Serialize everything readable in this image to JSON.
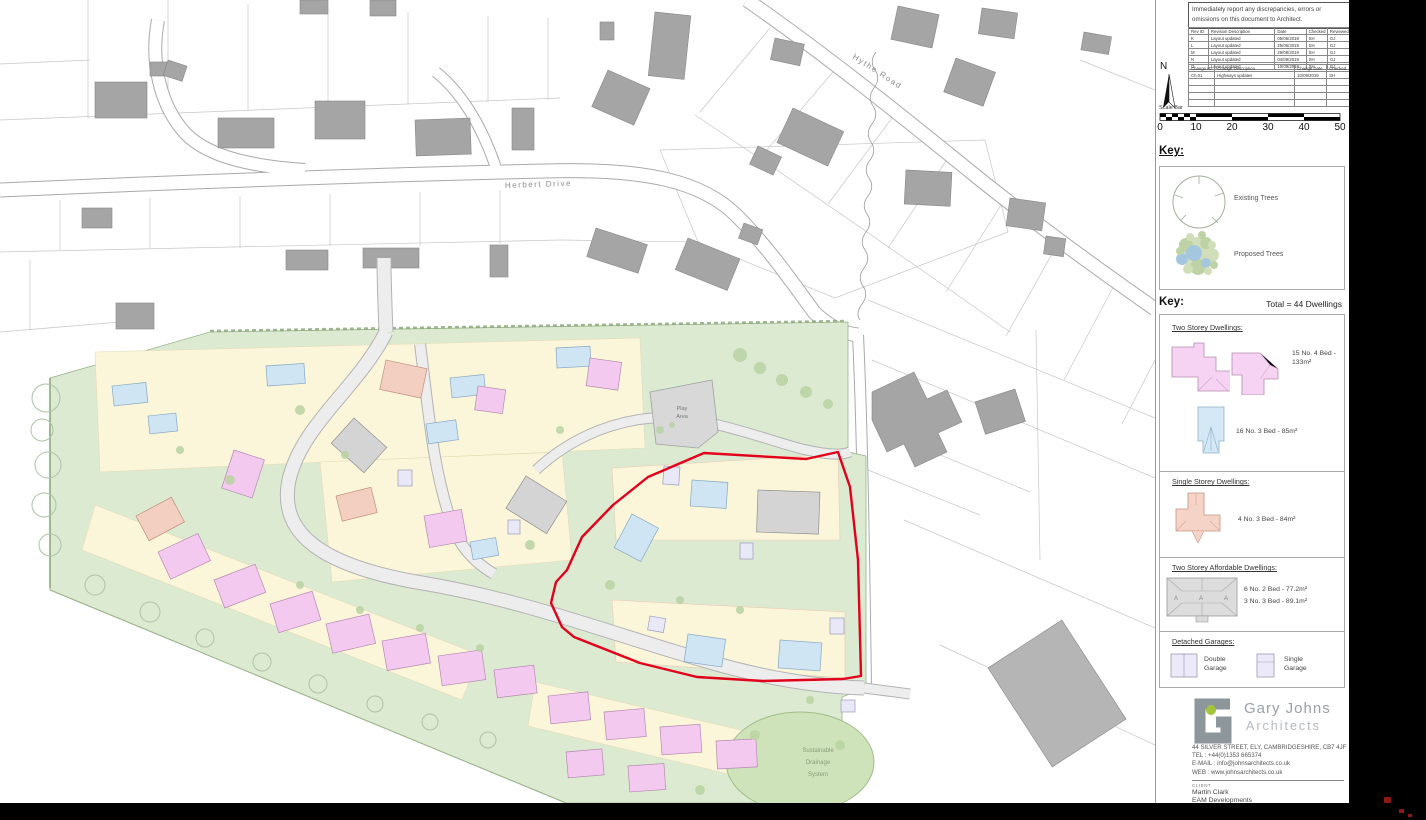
{
  "titleblock": {
    "warning": "Immediately report any discrepancies, errors or omissions on this document to Architect.",
    "revision_table": {
      "headers": [
        "Rev ID",
        "Revision Description",
        "Date",
        "Checked",
        "Reviewed"
      ],
      "rows": [
        [
          "K",
          "Layout updated",
          "05/06/2019",
          "SH",
          "GJ"
        ],
        [
          "L",
          "Layout updated",
          "25/06/2019",
          "SH",
          "GJ"
        ],
        [
          "M",
          "Layout updated",
          "29/08/2019",
          "SH",
          "GJ"
        ],
        [
          "N",
          "Layout updated",
          "04/09/2019",
          "SH",
          "GJ"
        ],
        [
          "O",
          "Layout updated",
          "10/09/2019",
          "SH",
          "GJ"
        ]
      ],
      "empty_rows": 0
    },
    "change_table": {
      "headers": [
        "Change ID",
        "Change Description",
        "Change Date",
        "Checked"
      ],
      "rows": [
        [
          "Ch.01",
          "Highways updates",
          "10/09/2019",
          "SH"
        ]
      ],
      "empty_rows": 4
    },
    "north_label": "N",
    "scale_bar": {
      "label": "Scale Bar",
      "ticks": [
        "0",
        "10",
        "20",
        "30",
        "40",
        "50"
      ]
    },
    "key_trees": {
      "title": "Key:",
      "existing_label": "Existing Trees",
      "proposed_label": "Proposed Trees"
    },
    "key_dwellings": {
      "title": "Key:",
      "total": "Total = 44 Dwellings",
      "sections": [
        {
          "heading": "Two Storey Dwellings:",
          "items": [
            "15 No. 4 Bed - 133m²",
            "16 No. 3 Bed - 85m²"
          ]
        },
        {
          "heading": "Single Storey Dwellings:",
          "items": [
            "4 No. 3 Bed - 84m²"
          ]
        },
        {
          "heading": "Two Storey Affordable Dwellings:",
          "items": [
            "6 No. 2 Bed - 77.2m²",
            "3 No. 3 Bed - 89.1m²"
          ]
        },
        {
          "heading": "Detached Garages:",
          "items": [
            "Double Garage",
            "Single Garage"
          ]
        }
      ]
    },
    "architect": {
      "name_line1": "Gary Johns",
      "name_line2": "Architects",
      "address": "44 SILVER STREET, ELY, CAMBRIDGESHIRE, CB7 4JF",
      "tel": "TEL : +44(0)1353 665374",
      "email": "E-MAIL : info@johnsarchitects.co.uk",
      "web": "WEB : www.johnsarchitects.co.uk"
    },
    "client": {
      "label": "CLIENT",
      "name": "Martin Clark",
      "company": "EAM Developments"
    }
  },
  "map": {
    "labels": {
      "herbert_drive": "Herbert Drive",
      "hythe_road": "Hythe Road",
      "play_1": "Play",
      "play_2": "Area",
      "suds_1": "Sustainable",
      "suds_2": "Drainage",
      "suds_3": "System"
    },
    "colors": {
      "site_green": "#dcead2",
      "plot_cream": "#fbf6da",
      "two_storey_pink": "#f4c9f0",
      "three_bed_blue": "#cfe5f4",
      "single_storey_salmon": "#f3cfc1",
      "affordable_grey": "#d4d4d4",
      "garage_lavender": "#e9e8f7",
      "boundary_red": "#e2001a",
      "existing_building_grey": "#a5a5a5",
      "logo_green": "#a3c53a",
      "logo_grey": "#8d969b"
    }
  }
}
